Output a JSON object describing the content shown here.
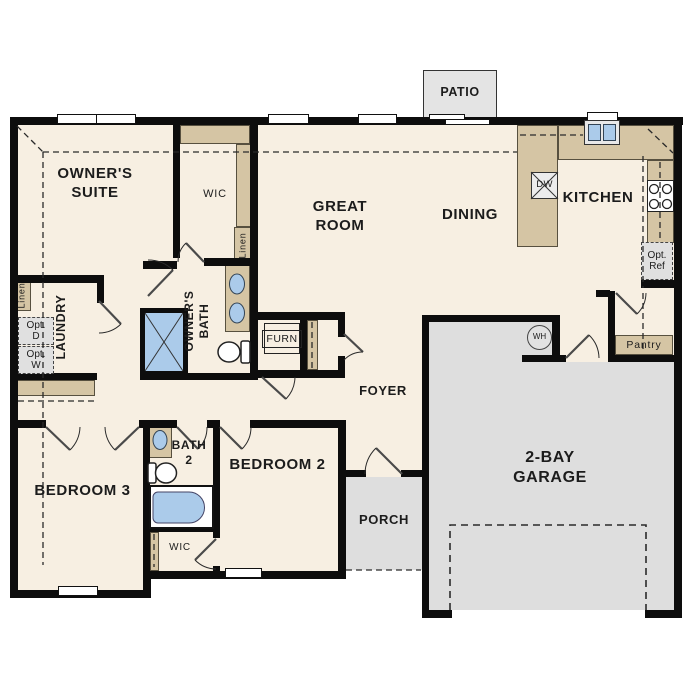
{
  "rooms": {
    "owners_suite": [
      "OWNER'S",
      "SUITE"
    ],
    "wic_owners": "WIC",
    "great_room": [
      "GREAT",
      "ROOM"
    ],
    "dining": "DINING",
    "kitchen": "KITCHEN",
    "patio": "PATIO",
    "laundry": "LAUNDRY",
    "owners_bath": [
      "OWNER'S",
      "BATH"
    ],
    "foyer": "FOYER",
    "pantry": "Pantry",
    "bedroom3": "BEDROOM 3",
    "bath2": [
      "BATH",
      "2"
    ],
    "bedroom2": "BEDROOM 2",
    "wic_bedroom": "WIC",
    "porch": "PORCH",
    "garage": [
      "2-BAY",
      "GARAGE"
    ]
  },
  "fixtures": {
    "dishwasher": "DW",
    "water_heater": "WH",
    "furnace": "FURN",
    "linen_hall": "Linen",
    "linen_wic": "Linen",
    "opt_dryer": [
      "Opt.",
      "D"
    ],
    "opt_washer": [
      "Opt.",
      "W"
    ],
    "opt_fridge": [
      "Opt.",
      "Ref"
    ]
  },
  "colors": {
    "floor": "#f7efe2",
    "hardscape": "#dedede",
    "counter": "#d5c5a4",
    "fixture_blue": "#abcbea",
    "wall": "#0d0d0d"
  }
}
